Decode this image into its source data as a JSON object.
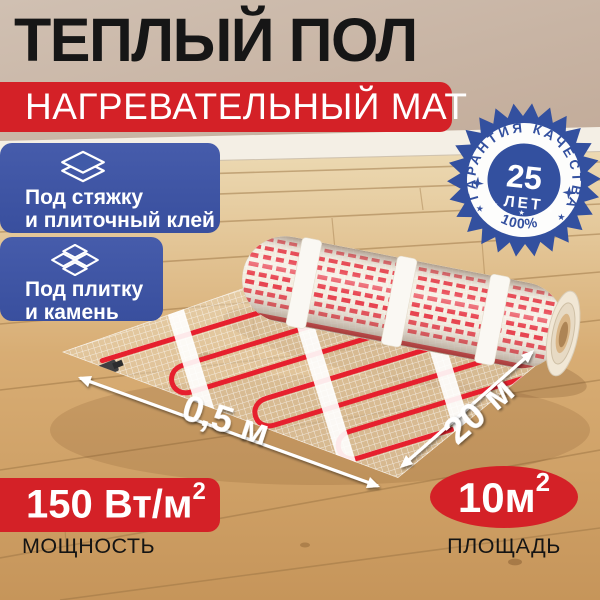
{
  "title": "ТЕПЛЫЙ ПОЛ",
  "subtitle": "НАГРЕВАТЕЛЬНЫЙ МАТ",
  "features": [
    {
      "icon": "layers-icon",
      "line1": "Под стяжку",
      "line2": "и плиточный клей"
    },
    {
      "icon": "tiles-icon",
      "line1": "Под плитку",
      "line2": "и камень"
    }
  ],
  "guarantee": {
    "arc_top": "ГАРАНТИЯ КАЧЕСТВА",
    "years_value": "25",
    "years_label": "ЛЕТ",
    "arc_bottom": "100%"
  },
  "dimensions": {
    "width_label": "0,5 м",
    "length_label": "20 м"
  },
  "specs": {
    "power": {
      "value_base": "150 Вт/м",
      "value_sup": "2",
      "label": "МОЩНОСТЬ"
    },
    "area": {
      "value_base": "10м",
      "value_sup": "2",
      "label": "ПЛОЩАДЬ"
    }
  },
  "colors": {
    "accent_red": "#d42127",
    "badge_blue": "#3e56a6",
    "seal_blue": "#33509f",
    "title_black": "#161616",
    "text_white": "#ffffff"
  }
}
